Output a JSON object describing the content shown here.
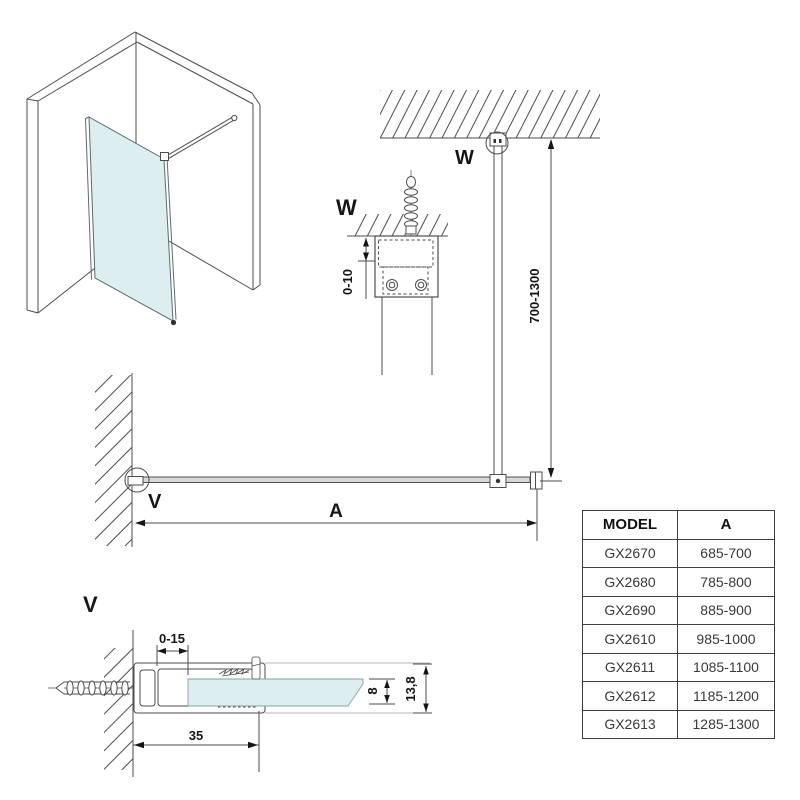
{
  "plan": {
    "marker_top": "W",
    "marker_wall": "V",
    "dim_height": "700-1300",
    "dim_width": "A"
  },
  "detail_w": {
    "label": "W",
    "dim_gap": "0-10"
  },
  "detail_v": {
    "label": "V",
    "dim_play": "0-15",
    "dim_depth": "35",
    "dim_glass_thickness": "8",
    "dim_profile_thickness": "13,8"
  },
  "table": {
    "headers": [
      "MODEL",
      "A"
    ],
    "rows": [
      [
        "GX2670",
        "685-700"
      ],
      [
        "GX2680",
        "785-800"
      ],
      [
        "GX2690",
        "885-900"
      ],
      [
        "GX2610",
        "985-1000"
      ],
      [
        "GX2611",
        "1085-1100"
      ],
      [
        "GX2612",
        "1185-1200"
      ],
      [
        "GX2613",
        "1285-1300"
      ]
    ]
  },
  "colors": {
    "line": "#4d4d4d",
    "glass": "#dceef0",
    "plan_glass_fill": "#d9d9d9",
    "trim_gray": "#b8b8b8",
    "table_border": "#3f3f3f",
    "text": "#161616"
  }
}
